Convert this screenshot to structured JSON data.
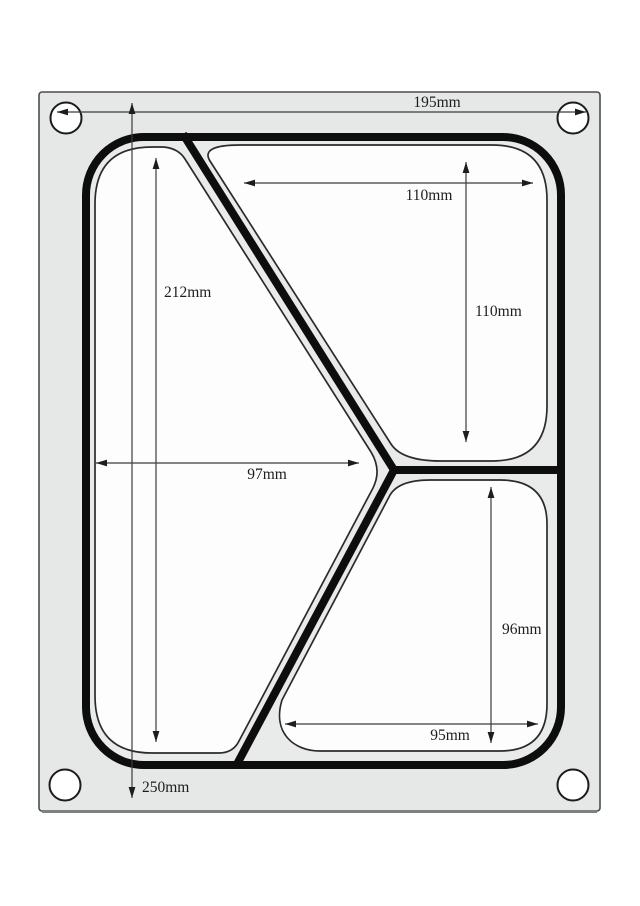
{
  "figure": {
    "type": "technical-dimension-diagram",
    "colors": {
      "background": "#ffffff",
      "plate": "#e6e8e7",
      "seal_interior": "#e9ebea",
      "compartment": "#fdfdfd",
      "thick_line": "#0d0d0d",
      "thin_line": "#2b2b2b",
      "dim_line": "#3c3c3c",
      "plate_edge": "#4a4d4c",
      "plate_shadow": "#7d8281"
    },
    "dimensions": [
      {
        "name": "plate-width",
        "label": "195mm"
      },
      {
        "name": "plate-height",
        "label": "250mm"
      },
      {
        "name": "left-compartment-height",
        "label": "212mm"
      },
      {
        "name": "left-compartment-width",
        "label": "97mm"
      },
      {
        "name": "top-compartment-width",
        "label": "110mm"
      },
      {
        "name": "top-compartment-height",
        "label": "110mm"
      },
      {
        "name": "bottom-compartment-height",
        "label": "96mm"
      },
      {
        "name": "bottom-compartment-width",
        "label": "95mm"
      }
    ]
  }
}
